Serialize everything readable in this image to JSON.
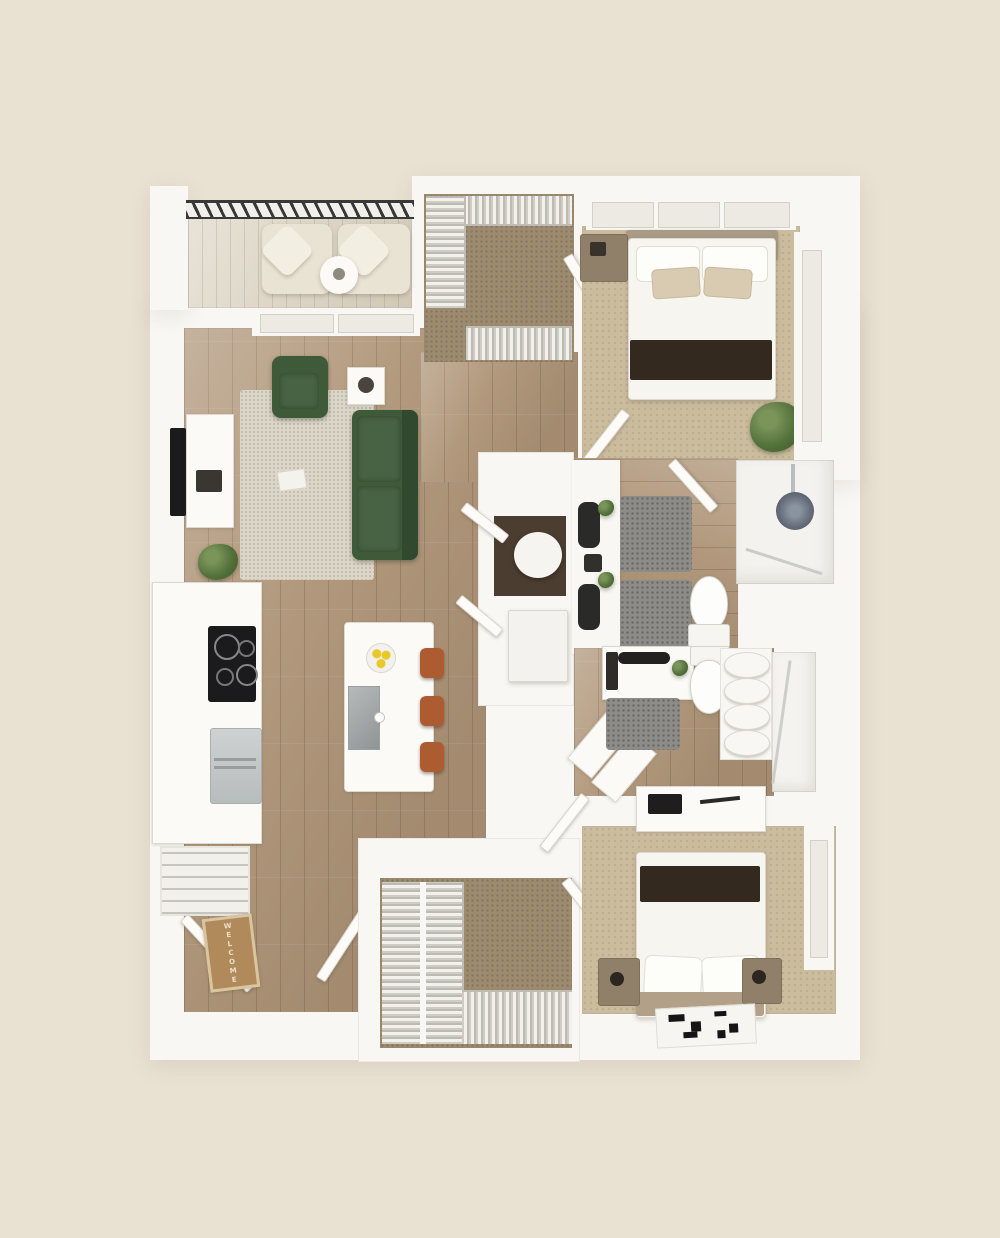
{
  "scene": {
    "type": "3d-floor-plan-render",
    "description": "Top-down 3D rendering of a two-bedroom / two-bathroom apartment floor plan with balcony, open kitchen-living area, walk-in closets and laundry nook, on a beige background.",
    "welcome_mat": {
      "text": "WELCOME"
    },
    "palette": {
      "bg": "#e9e1d2",
      "wall": "#f8f7f3",
      "wood": "#b2997d",
      "carpet_tan": "#cbbc9e",
      "carpet_brown": "#9d8b70",
      "rug_light": "#dcd6c8",
      "rug_gray": "#8d8c88",
      "green": "#3e5a39",
      "green_dark": "#31492e",
      "rust": "#ad5c32",
      "throw": "#33291f",
      "railing": "#383838",
      "steel": "#c3c6c6",
      "black": "#1b1b1d",
      "mat": "#b08a5a",
      "mat_text": "#ece1cb",
      "nook_floor": "#4c3d31",
      "plant": "#55733c",
      "lemon": "#e9c829"
    },
    "rooms": [
      {
        "id": "balcony",
        "furniture": [
          "railing",
          "two lounge chairs",
          "round side table"
        ]
      },
      {
        "id": "living-room",
        "furniture": [
          "green sofa",
          "green armchair",
          "round coffee table",
          "side table",
          "area rug",
          "wall TV",
          "media console",
          "plant"
        ]
      },
      {
        "id": "kitchen",
        "furniture": [
          "counter",
          "cooktop",
          "refrigerator",
          "pantry shelves",
          "island with sink",
          "fruit bowl",
          "3 bar stools"
        ]
      },
      {
        "id": "entry",
        "furniture": [
          "entry door",
          "welcome mat"
        ]
      },
      {
        "id": "walk-in-closet-top",
        "furniture": [
          "clothes racks",
          "door"
        ]
      },
      {
        "id": "bedroom-1",
        "furniture": [
          "queen bed",
          "nightstand",
          "plant",
          "windows",
          "door"
        ]
      },
      {
        "id": "laundry-nook",
        "furniture": [
          "bistro table",
          "washer-dryer"
        ]
      },
      {
        "id": "bathroom-1",
        "furniture": [
          "double vanity with dark sinks",
          "two bath rugs",
          "toilet",
          "walk-in shower",
          "door"
        ]
      },
      {
        "id": "bathroom-2",
        "furniture": [
          "vanity",
          "toilet",
          "towel shelf",
          "shower",
          "laundry baskets",
          "bath rug"
        ]
      },
      {
        "id": "walk-in-closet-bottom",
        "furniture": [
          "clothes racks",
          "door"
        ]
      },
      {
        "id": "bedroom-2",
        "furniture": [
          "queen bed",
          "two nightstands",
          "dresser",
          "patterned rug",
          "windows",
          "door"
        ]
      }
    ]
  }
}
